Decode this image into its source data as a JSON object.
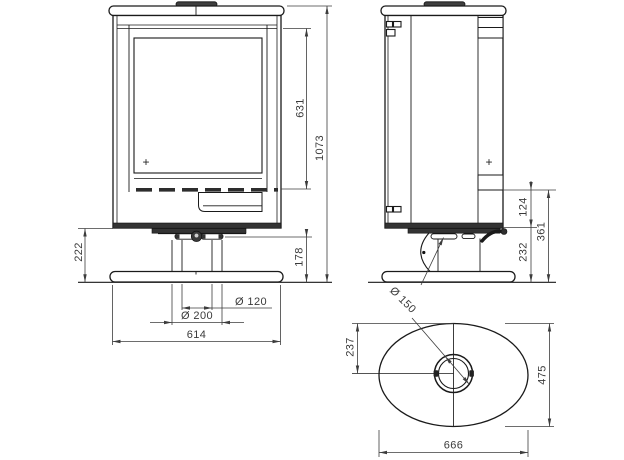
{
  "colors": {
    "background": "#ffffff",
    "object_line": "#1a1a1a",
    "dimension_line": "#3c3c3c",
    "text": "#3a3a3a",
    "dark_fill": "#353535"
  },
  "views": {
    "front": {
      "dims": {
        "door_height": "631",
        "overall_height": "1073",
        "pedestal_height": "222",
        "base_height": "178",
        "hole_diameter": "Ø 120",
        "mount_diameter": "Ø 200",
        "base_width": "614"
      },
      "center_mark": "+"
    },
    "side": {
      "dims": {
        "rear_offset": "124",
        "connection_height": "361",
        "lower_clearance": "232",
        "column_diameter": "Ø 150"
      },
      "center_mark": "+"
    },
    "top": {
      "dims": {
        "center_offset": "237",
        "plate_depth": "475",
        "plate_length": "666"
      }
    }
  }
}
